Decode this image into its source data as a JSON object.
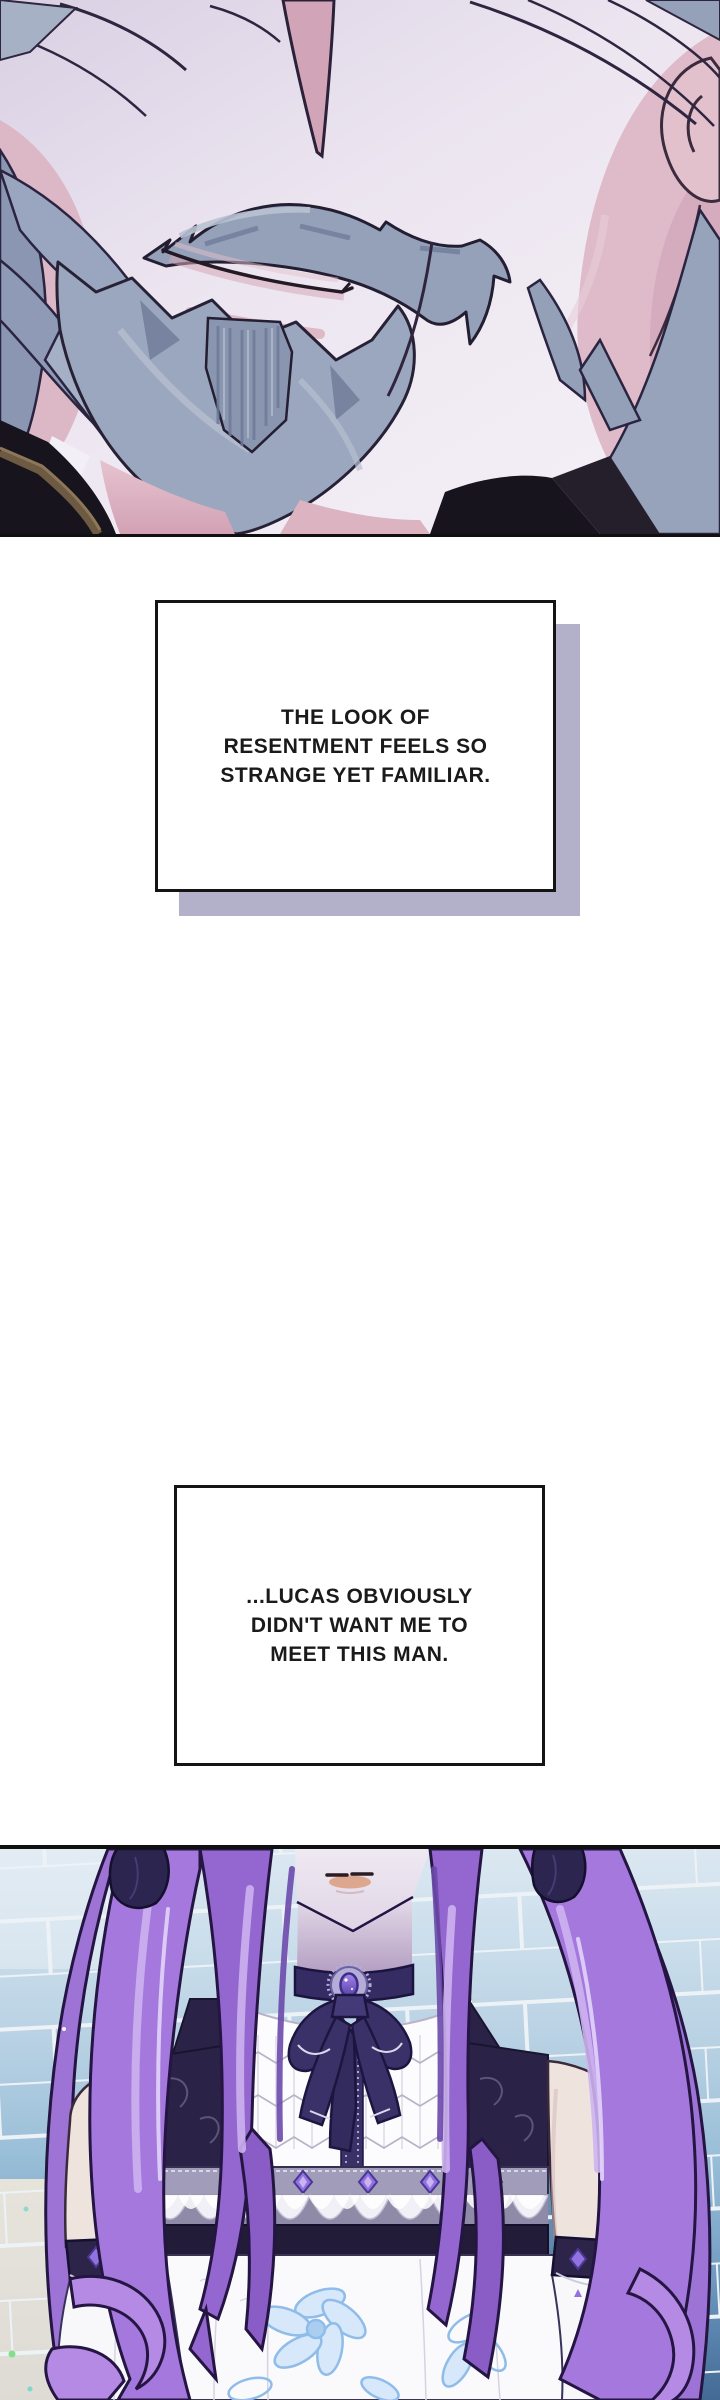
{
  "monologue_boxes": [
    {
      "lines": [
        "THE LOOK OF",
        "RESENTMENT FEELS SO",
        "STRANGE YET FAMILIAR."
      ]
    },
    {
      "lines": [
        "...LUCAS OBVIOUSLY",
        "DIDN'T WANT ME TO",
        "MEET THIS MAN."
      ]
    }
  ],
  "palette": {
    "page_background": "#ffffff",
    "panel_border": "#101010",
    "textbox_border": "#141414",
    "textbox_shadow": "#b3b1c9",
    "text_color": "#1a1a1a",
    "mustache_grey": "#95a1b9",
    "beard_grey": "#9ba7be",
    "face_skin_pink": "#dcb7c6",
    "collar_black": "#17141d",
    "strap_brown": "#6d5a42",
    "hair_purple": "#a478dc",
    "hair_purple_dark": "#6b49ab",
    "hair_highlight": "#cdb2f0",
    "tile_blue_light": "#dde9f2",
    "tile_blue_dark": "#3f6691",
    "choker_purple": "#362c64",
    "gem_purple": "#9272e0",
    "skirt_flower_blue": "#8fbce9"
  }
}
